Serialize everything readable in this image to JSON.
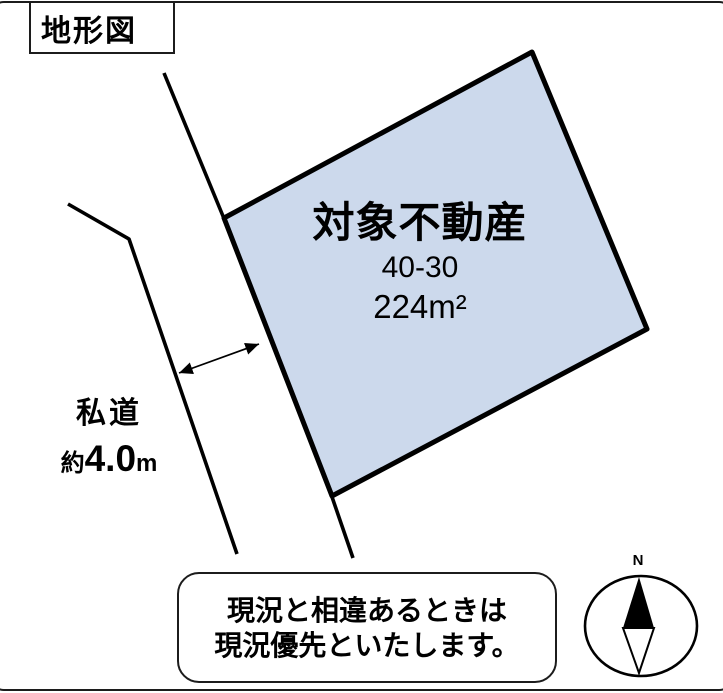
{
  "diagram": {
    "title": "地形図",
    "parcel": {
      "label": "対象不動産",
      "lot_number": "40-30",
      "area_value": "224",
      "area_unit": "m²",
      "fill_color": "#ccd9ec"
    },
    "road": {
      "label": "私道",
      "width_prefix": "約",
      "width_value": "4.0",
      "width_unit": "m"
    },
    "note": {
      "line1": "現況と相違あるときは",
      "line2": "現況優先といたします。"
    },
    "compass": {
      "north_label": "N"
    },
    "colors": {
      "line": "#000000",
      "parcel_fill": "#ccd9ec",
      "background": "#ffffff"
    }
  }
}
